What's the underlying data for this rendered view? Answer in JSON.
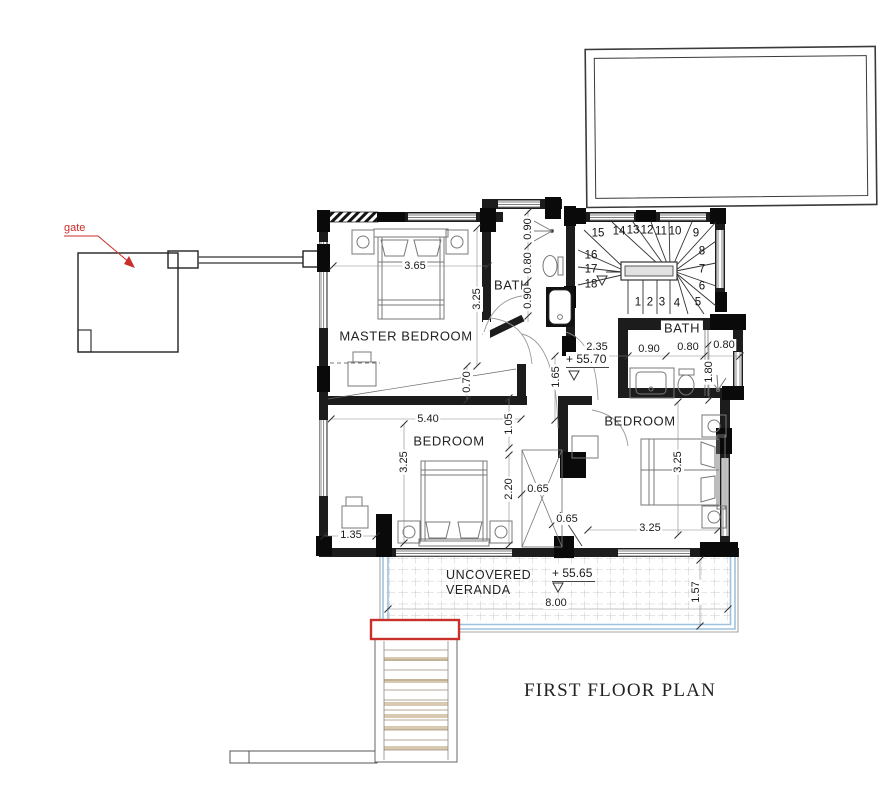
{
  "title": "FIRST FLOOR PLAN",
  "annotations": {
    "gate_label": "gate",
    "level_hall": "+ 55.70",
    "level_veranda": "+ 55.65"
  },
  "rooms": {
    "master_bedroom": "MASTER BEDROOM",
    "bath_top": "BATH",
    "bath_right": "BATH",
    "bedroom_left": "BEDROOM",
    "bedroom_right": "BEDROOM",
    "veranda_line1": "UNCOVERED",
    "veranda_line2": "VERANDA"
  },
  "dimensions": {
    "master_width": "3.65",
    "master_height": "3.25",
    "bath_top_seg1": "0.90",
    "bath_top_seg2": "0.80",
    "bath_top_seg3": "0.90",
    "wall_offset": "0.70",
    "bedroom_left_width": "5.40",
    "hall_width": "1.05",
    "bedroom_left_height": "3.25",
    "bedroom_left_inner": "2.20",
    "closet_a": "0.65",
    "closet_b": "0.65",
    "desk_width": "1.35",
    "bedroom_right_height": "3.25",
    "bedroom_right_width": "3.25",
    "hall_length": "2.35",
    "bath_right_seg1": "0.90",
    "bath_right_seg2": "0.80",
    "bath_right_seg3": "0.80",
    "bath_right_depth": "1.80",
    "hall_depth": "1.65",
    "veranda_width": "8.00",
    "veranda_depth": "1.57"
  },
  "stairs": {
    "numbers": [
      "1",
      "2",
      "3",
      "4",
      "5",
      "6",
      "7",
      "8",
      "9",
      "10",
      "11",
      "12",
      "13",
      "14",
      "15",
      "16",
      "17",
      "18"
    ]
  },
  "colors": {
    "red_accent": "#c9302c",
    "veranda_blue": "#9cc2e0",
    "stair_tan": "#d8c9b0",
    "wall_dark": "#1c1c1c"
  }
}
